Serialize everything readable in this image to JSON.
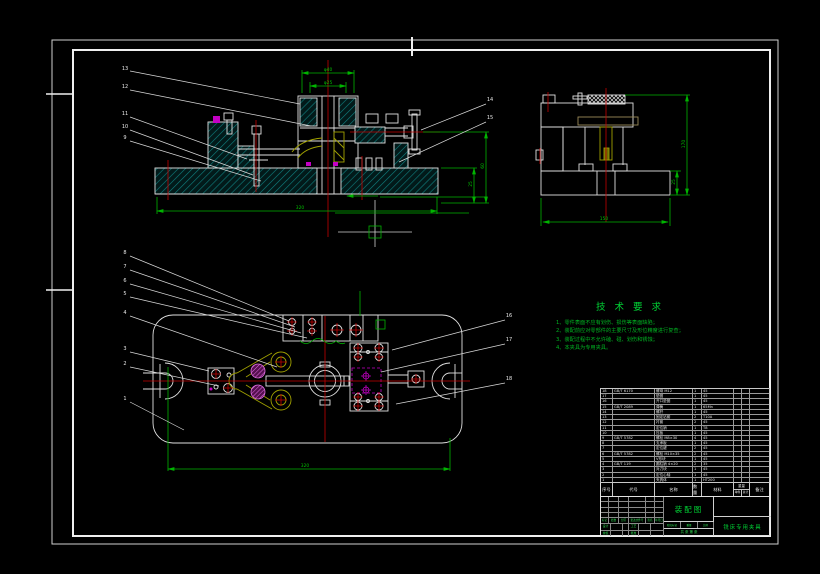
{
  "callouts": [
    "1",
    "2",
    "3",
    "4",
    "5",
    "6",
    "7",
    "8",
    "9",
    "10",
    "11",
    "12",
    "13",
    "14",
    "15",
    "16",
    "17",
    "18"
  ],
  "tech": {
    "title": "技 术 要 求",
    "items": [
      "1、零件表面不应有划伤、损伤等表面缺陷；",
      "2、装配前应对零部件的主要尺寸及形位精度进行复查；",
      "3、装配过程中不允许磕、碰、划伤和锈蚀；",
      "4、本夹具为专用夹具。"
    ]
  },
  "dims": {
    "front_top_outer": "φ40",
    "front_top_inner": "φ25",
    "front_bottom": "320",
    "front_right_height": "60",
    "front_right_base": "25",
    "side_height": "170",
    "side_base": "25",
    "side_bottom": "150",
    "plan_bottom": "320"
  },
  "bom": {
    "headers": {
      "no": "序号",
      "code": "代号",
      "name": "名称",
      "qty": "数量",
      "material": "材料",
      "weight": "重量",
      "single": "单件",
      "total": "总计",
      "remark": "备注"
    },
    "rows": [
      {
        "no": "18",
        "code": "GB/T 6170",
        "name": "螺母 M12",
        "qty": "1",
        "material": "45",
        "remark": ""
      },
      {
        "no": "17",
        "code": "",
        "name": "垫圈",
        "qty": "1",
        "material": "45",
        "remark": ""
      },
      {
        "no": "16",
        "code": "",
        "name": "开口垫圈",
        "qty": "1",
        "material": "45",
        "remark": ""
      },
      {
        "no": "15",
        "code": "GB/T 2089",
        "name": "弹簧",
        "qty": "1",
        "material": "65Mn",
        "remark": ""
      },
      {
        "no": "14",
        "code": "",
        "name": "螺杆",
        "qty": "1",
        "material": "45",
        "remark": ""
      },
      {
        "no": "13",
        "code": "",
        "name": "固定钻套",
        "qty": "2",
        "material": "T10A",
        "remark": ""
      },
      {
        "no": "12",
        "code": "",
        "name": "衬套",
        "qty": "2",
        "material": "45",
        "remark": ""
      },
      {
        "no": "11",
        "code": "",
        "name": "定位销",
        "qty": "1",
        "material": "T8",
        "remark": ""
      },
      {
        "no": "10",
        "code": "",
        "name": "压板",
        "qty": "1",
        "material": "45",
        "remark": ""
      },
      {
        "no": "9",
        "code": "GB/T 5782",
        "name": "螺栓 M8×30",
        "qty": "4",
        "material": "45",
        "remark": ""
      },
      {
        "no": "8",
        "code": "",
        "name": "支承板",
        "qty": "1",
        "material": "45",
        "remark": ""
      },
      {
        "no": "7",
        "code": "",
        "name": "定位键",
        "qty": "2",
        "material": "45",
        "remark": ""
      },
      {
        "no": "6",
        "code": "GB/T 5782",
        "name": "螺栓 M10×35",
        "qty": "2",
        "material": "45",
        "remark": ""
      },
      {
        "no": "5",
        "code": "",
        "name": "V形块",
        "qty": "1",
        "material": "45",
        "remark": ""
      },
      {
        "no": "4",
        "code": "GB/T 119",
        "name": "圆柱销 4×20",
        "qty": "2",
        "material": "35",
        "remark": ""
      },
      {
        "no": "3",
        "code": "",
        "name": "对刀块",
        "qty": "1",
        "material": "45",
        "remark": ""
      },
      {
        "no": "2",
        "code": "",
        "name": "定位心轴",
        "qty": "1",
        "material": "45",
        "remark": ""
      },
      {
        "no": "1",
        "code": "",
        "name": "夹具体",
        "qty": "1",
        "material": "HT200",
        "remark": ""
      }
    ]
  },
  "title_block": {
    "drawing_type": "装配图",
    "drawing_name": "铣床专用夹具",
    "revision_labels": [
      "标记",
      "处数",
      "分区",
      "更改文件号",
      "签名",
      "年月日"
    ],
    "role_labels": [
      "设计",
      "工艺",
      "校核",
      "批准"
    ],
    "stage_labels": [
      "阶段标记",
      "重量",
      "比例"
    ],
    "sheet_label": "共 张 第 张"
  },
  "colors": {
    "background": "#000000",
    "line": "#e0e0e0",
    "dimension": "#00b300",
    "centerline": "#c40000",
    "hidden": "#c400c4",
    "detail": "#a0a000",
    "hatch": "#108080",
    "annotation": "#00cc33"
  }
}
